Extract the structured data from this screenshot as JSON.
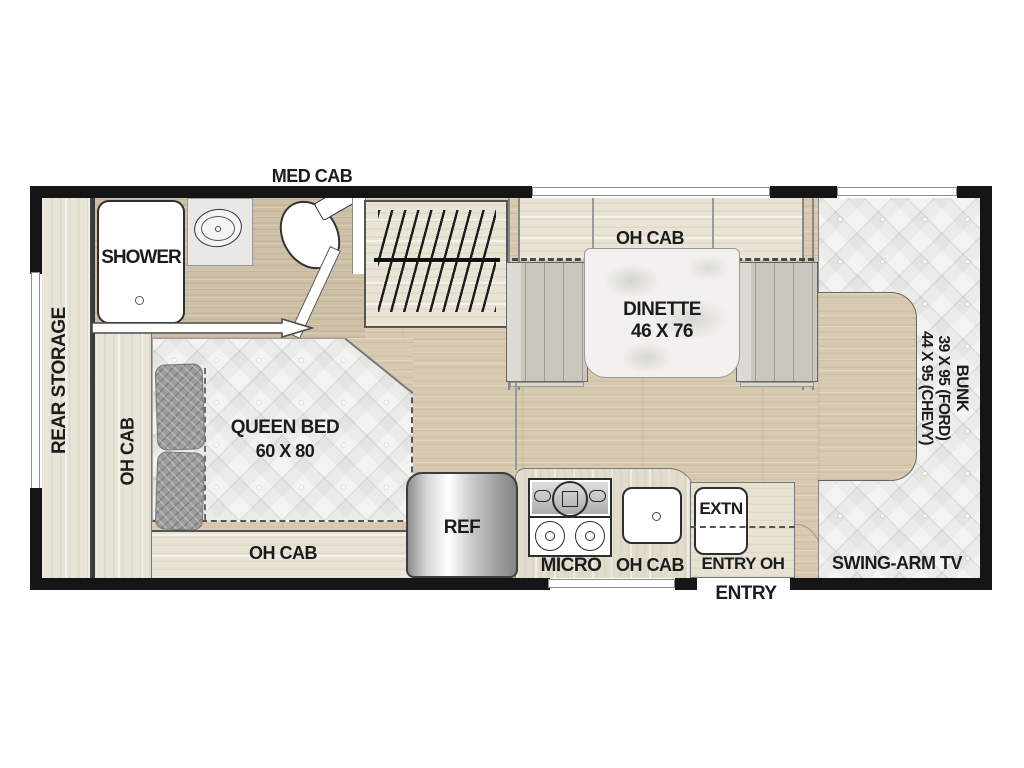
{
  "plan": {
    "title": "RV floor plan",
    "labels": {
      "med_cab": "MED CAB",
      "shower": "SHOWER",
      "rear_storage": "REAR STORAGE",
      "oh_cab": "OH CAB",
      "queen_bed": "QUEEN BED",
      "queen_bed_size": "60 X 80",
      "dinette": "DINETTE",
      "dinette_size": "46 X 76",
      "ref": "REF",
      "micro": "MICRO",
      "extn": "EXTN",
      "entry_oh": "ENTRY OH",
      "entry": "ENTRY",
      "swing_arm_tv": "SWING-ARM TV",
      "bunk": "BUNK",
      "bunk_size_ford": "39 X 95 (FORD)",
      "bunk_size_chevy": "44 X 95 (CHEVY)"
    },
    "colors": {
      "wall": "#151515",
      "floor_wood": "#d7cab1",
      "bath_floor": "#cdc0a6",
      "cabinet_wood": "#e9e4d8",
      "upholstery": "#f3f3f1",
      "bench": "#c9c6be",
      "text": "#1c1c1c"
    }
  }
}
